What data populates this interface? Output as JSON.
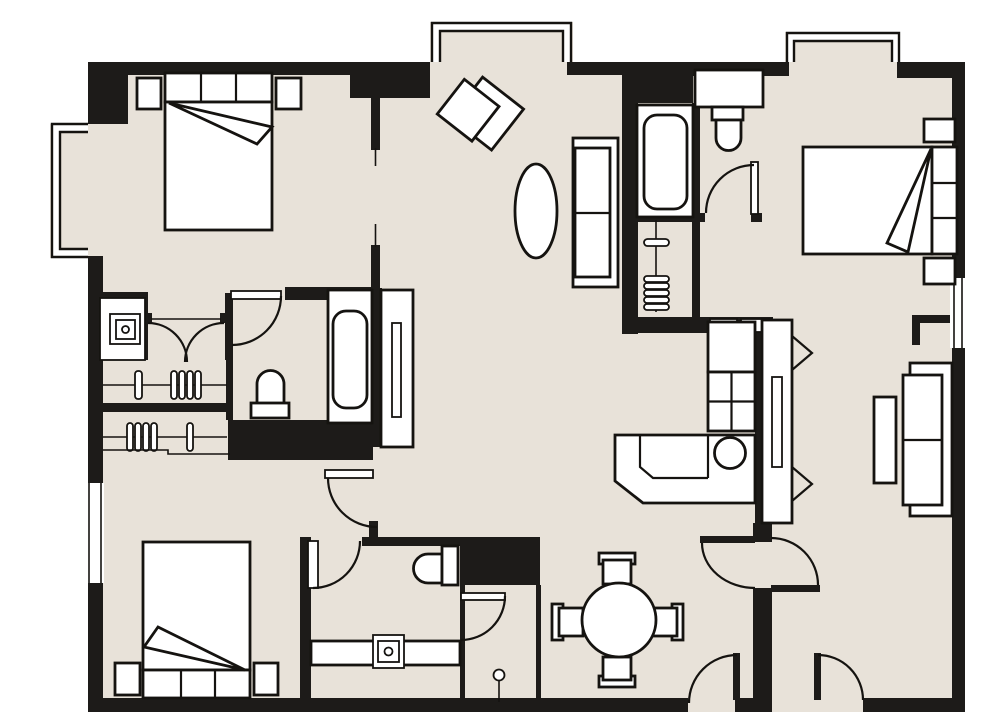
{
  "meta": {
    "kind": "architectural-floor-plan",
    "visible_text": "",
    "units_shown": false
  },
  "colors": {
    "background": "#ffffff",
    "floor": "#E8E2D9",
    "wall": "#1D1B19",
    "line": "#151310",
    "furniture_fill": "#ffffff"
  },
  "rooms": [
    {
      "id": "bedroom-1",
      "position": "top-left",
      "features": [
        "double-bed",
        "two-nightstands",
        "bay-window-left"
      ]
    },
    {
      "id": "closet-hall",
      "position": "mid-left",
      "features": [
        "two-hanging-closets",
        "french-doors",
        "safe-niche"
      ]
    },
    {
      "id": "bathroom-1",
      "position": "center-left",
      "features": [
        "toilet",
        "bathtub",
        "entry-door"
      ]
    },
    {
      "id": "bedroom-2",
      "position": "bottom-left",
      "features": [
        "double-bed",
        "two-nightstands",
        "window-left"
      ]
    },
    {
      "id": "bathroom-2",
      "position": "bottom-center",
      "features": [
        "toilet",
        "vanity-sink",
        "door"
      ]
    },
    {
      "id": "wc",
      "position": "bottom-center-right",
      "features": [
        "door",
        "floor-pin"
      ]
    },
    {
      "id": "living-room",
      "position": "center",
      "features": [
        "armchair",
        "oval-table",
        "loveseat",
        "console",
        "bay-window-top"
      ]
    },
    {
      "id": "bathroom-3",
      "position": "top-right-center",
      "features": [
        "bathtub",
        "sink-counter",
        "door"
      ]
    },
    {
      "id": "closet-right",
      "position": "center-right",
      "features": [
        "hanging-rod"
      ]
    },
    {
      "id": "kitchen",
      "position": "center-right",
      "features": [
        "l-counter",
        "round-sink",
        "cooktop-2x2",
        "cabinet"
      ]
    },
    {
      "id": "bedroom-3",
      "position": "top-right",
      "features": [
        "double-bed",
        "two-nightstands",
        "bay-window-top"
      ]
    },
    {
      "id": "living-room-2",
      "position": "right",
      "features": [
        "sofa",
        "coffee-table",
        "console-bifold",
        "window-right"
      ]
    },
    {
      "id": "dining-area",
      "position": "bottom-right-center",
      "features": [
        "round-table",
        "four-chairs"
      ]
    },
    {
      "id": "entry",
      "position": "bottom-right",
      "features": [
        "two-entry-doors",
        "double-swing-door"
      ]
    }
  ],
  "doors": [
    {
      "id": "french-doors-closet",
      "type": "double-leaf"
    },
    {
      "id": "bathroom-1-door",
      "type": "single"
    },
    {
      "id": "bathroom-3-door",
      "type": "single"
    },
    {
      "id": "hall-door-living",
      "type": "single"
    },
    {
      "id": "bathroom-2-door",
      "type": "single"
    },
    {
      "id": "wc-door",
      "type": "single"
    },
    {
      "id": "double-swing-door",
      "type": "double-acting"
    },
    {
      "id": "entry-door-left",
      "type": "single"
    },
    {
      "id": "entry-door-right",
      "type": "single"
    }
  ],
  "windows": [
    {
      "id": "bay-window-left"
    },
    {
      "id": "bay-window-top-center"
    },
    {
      "id": "bay-window-top-right"
    },
    {
      "id": "window-left-wall"
    },
    {
      "id": "window-right-wall"
    }
  ]
}
